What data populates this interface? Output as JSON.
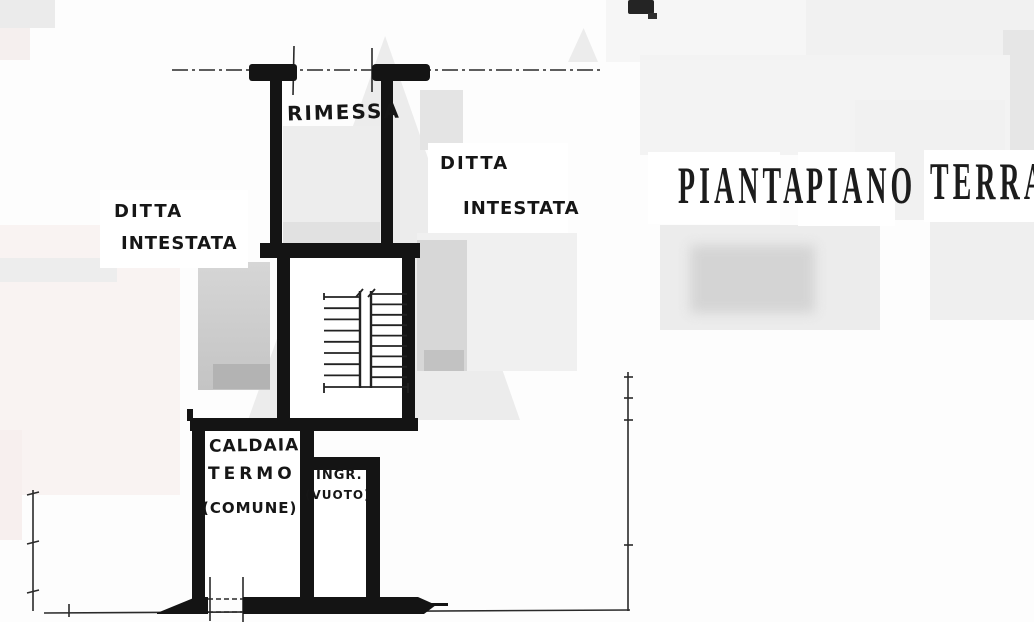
{
  "title": {
    "word1": "PIANTA",
    "word2": "PIANO",
    "word3": "TERRA"
  },
  "plan": {
    "rooms": {
      "rimessa": {
        "label": "RIMESSA"
      },
      "caldaia": {
        "label_line1": "CALDAIA",
        "label_line2": "TERMO",
        "label_line3": "(COMUNE)"
      },
      "ingresso": {
        "label_line1": "INGR.",
        "label_line2": "(VUOTO)"
      }
    },
    "annotations": {
      "owner_left_line1": "DITTA",
      "owner_left_line2": "INTESTATA",
      "owner_right_line1": "DITTA",
      "owner_right_line2": "INTESTATA"
    },
    "stairs": {
      "left_flight_steps": 8,
      "right_flight_steps": 9,
      "left_x1": 324,
      "left_x2": 359,
      "left_y_start": 297,
      "left_y_step": 11.2,
      "right_x1": 372,
      "right_x2": 407,
      "right_y_start": 294,
      "right_y_step": 10.4
    }
  },
  "colors": {
    "ink": "#141414",
    "thin_line": "#2a2a2a",
    "paper": "#fdfdfd",
    "watermark_gray": "#ececec",
    "room_wash": "#e9e9e9"
  }
}
